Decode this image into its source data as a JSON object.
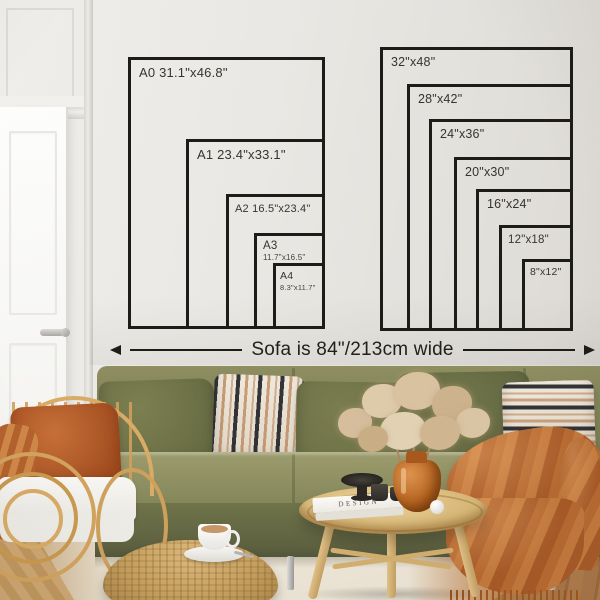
{
  "size_guide": {
    "left_panel": [
      {
        "line1": "A0 31.1\"x46.8\"",
        "line2": ""
      },
      {
        "line1": "A1 23.4\"x33.1\"",
        "line2": ""
      },
      {
        "line1": "A2 16.5\"x23.4\"",
        "line2": ""
      },
      {
        "line1": "A3",
        "line2": "11.7\"x16.5\""
      },
      {
        "line1": "A4",
        "line2": "8.3\"x11.7\""
      }
    ],
    "right_panel": [
      {
        "line1": "32\"x48\""
      },
      {
        "line1": "28\"x42\""
      },
      {
        "line1": "24\"x36\""
      },
      {
        "line1": "20\"x30\""
      },
      {
        "line1": "16\"x24\""
      },
      {
        "line1": "12\"x18\""
      },
      {
        "line1": "8\"x12\""
      }
    ],
    "sofa_width_label": "Sofa is 84\"/213cm wide"
  },
  "scene": {
    "book_spine_text": "DESIGN"
  },
  "colors": {
    "diagram_line": "#1d1c19",
    "wall": "#e9e7e3",
    "sofa_olive": "#83855a",
    "pillow_dark_olive": "#6a6e44",
    "rust_accent": "#b5652f",
    "rattan_wood": "#d2a35e",
    "floor_wood": "#a9764a",
    "rug_cream": "#ece5d6"
  }
}
